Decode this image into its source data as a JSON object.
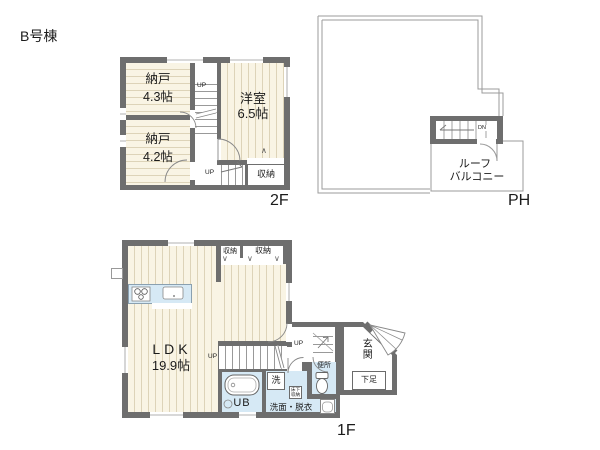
{
  "building_label": "B号棟",
  "shared": {
    "up": "UP",
    "dn": "DN"
  },
  "marks": {
    "fold_down": "∨",
    "fold_up": "∧"
  },
  "floor2": {
    "label": "2F",
    "nando1": {
      "name": "納戸",
      "size": "4.3帖"
    },
    "nando2": {
      "name": "納戸",
      "size": "4.2帖"
    },
    "yoshitsu": {
      "name": "洋室",
      "size": "6.5帖"
    },
    "closet": "収納"
  },
  "ph": {
    "label": "PH",
    "balcony": {
      "line1": "ルーフ",
      "line2": "バルコニー"
    }
  },
  "floor1": {
    "label": "1F",
    "ldk": {
      "name": "LDK",
      "size": "19.9帖"
    },
    "closet_small": "収納",
    "closet_large": "収納",
    "washer": "洗",
    "washroom": "洗面・脱衣",
    "underfloor": {
      "line1": "床下",
      "line2": "収納"
    },
    "toilet": "便所",
    "entrance": "玄関",
    "shoe_box": "下足",
    "bath": "UB"
  },
  "colors": {
    "wall": "#6e6e6e",
    "floor_wood": "#f9f4e4",
    "water_blue": "#d6e9f5",
    "roof_outline": "#9b9b9b"
  }
}
